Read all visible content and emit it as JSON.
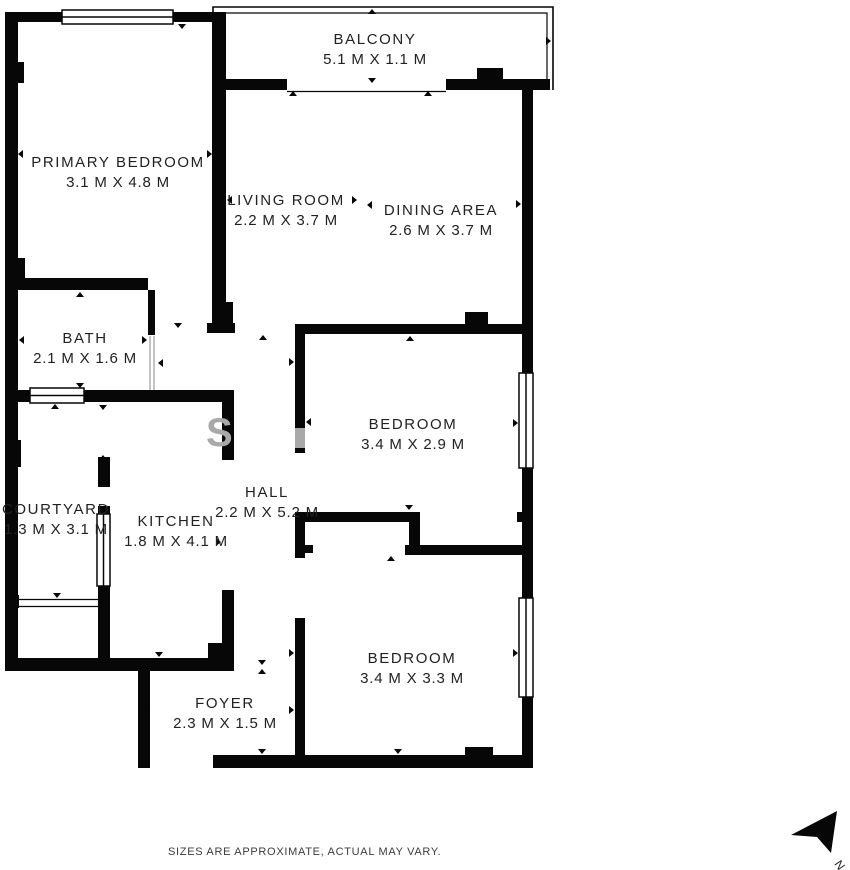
{
  "plan": {
    "rooms": [
      {
        "id": "balcony",
        "name": "BALCONY",
        "dims": "5.1 M X 1.1 M"
      },
      {
        "id": "primary-bedroom",
        "name": "PRIMARY BEDROOM",
        "dims": "3.1 M X 4.8 M"
      },
      {
        "id": "living-room",
        "name": "LIVING ROOM",
        "dims": "2.2 M X 3.7 M"
      },
      {
        "id": "dining-area",
        "name": "DINING AREA",
        "dims": "2.6 M X 3.7 M"
      },
      {
        "id": "bath",
        "name": "BATH",
        "dims": "2.1 M X 1.6 M"
      },
      {
        "id": "bedroom-1",
        "name": "BEDROOM",
        "dims": "3.4 M X 2.9 M"
      },
      {
        "id": "courtyard",
        "name": "COURTYARD",
        "dims": "1.3 M X 3.1 M"
      },
      {
        "id": "kitchen",
        "name": "KITCHEN",
        "dims": "1.8 M X 4.1 M"
      },
      {
        "id": "hall",
        "name": "HALL",
        "dims": "2.2 M X 5.2 M"
      },
      {
        "id": "bedroom-2",
        "name": "BEDROOM",
        "dims": "3.4 M X 3.3 M"
      },
      {
        "id": "foyer",
        "name": "FOYER",
        "dims": "2.3 M X 1.5 M"
      }
    ],
    "disclaimer": "SIZES ARE APPROXIMATE, ACTUAL MAY VARY.",
    "compass_label": "N",
    "watermark": "S",
    "colors": {
      "wall": "#070707",
      "text": "#222222",
      "watermark": "#a9a9a9"
    }
  }
}
